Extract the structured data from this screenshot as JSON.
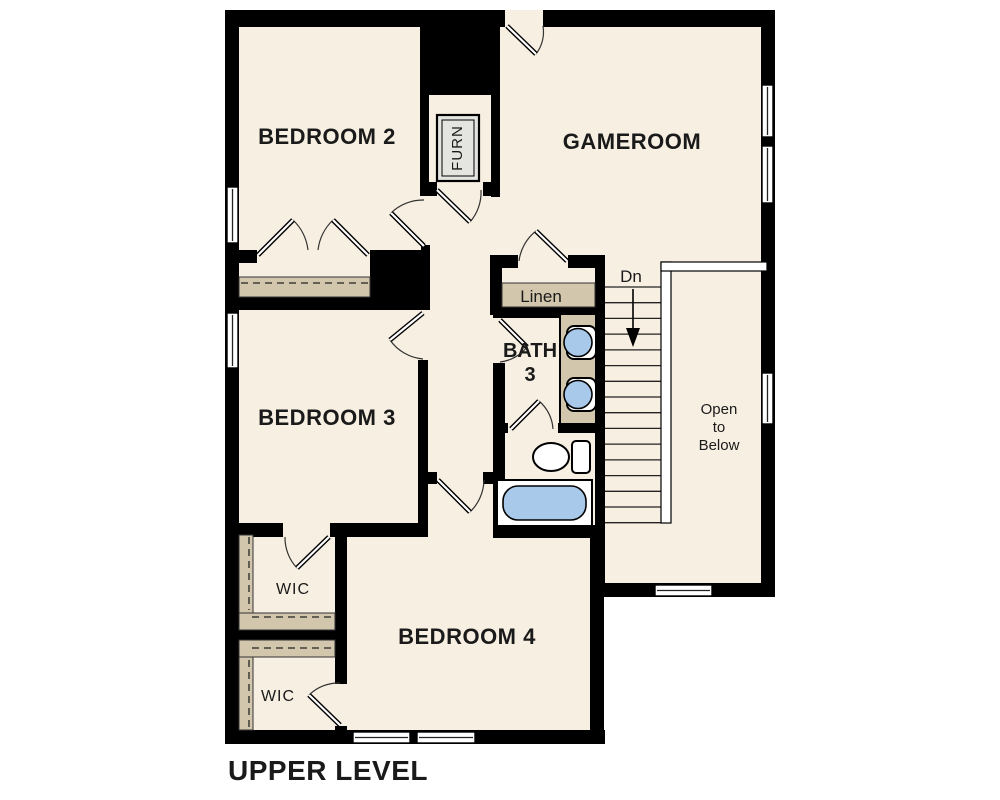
{
  "page": {
    "title": "UPPER LEVEL"
  },
  "rooms": {
    "bedroom2": {
      "label": "BEDROOM 2"
    },
    "gameroom": {
      "label": "GAMEROOM"
    },
    "bedroom3": {
      "label": "BEDROOM 3"
    },
    "bedroom4": {
      "label": "BEDROOM 4"
    },
    "bath3": {
      "label_line1": "BATH",
      "label_line2": "3"
    },
    "linen": {
      "label": "Linen"
    },
    "wic_upper": {
      "label": "WIC"
    },
    "wic_lower": {
      "label": "WIC"
    },
    "furnace_closet": {
      "label": "FURN"
    },
    "open_to_below": {
      "label_line1": "Open",
      "label_line2": "to",
      "label_line3": "Below"
    }
  },
  "stairs": {
    "direction_label": "Dn",
    "tread_count": 16
  },
  "colors": {
    "floor": "#f7efe1",
    "wall": "#000000",
    "shelf_tan": "#d2c7ac",
    "fixture_blue": "#a8c9e9",
    "furnace_gray": "#e4e4e0",
    "text": "#1a1a1a",
    "background": "#ffffff"
  }
}
